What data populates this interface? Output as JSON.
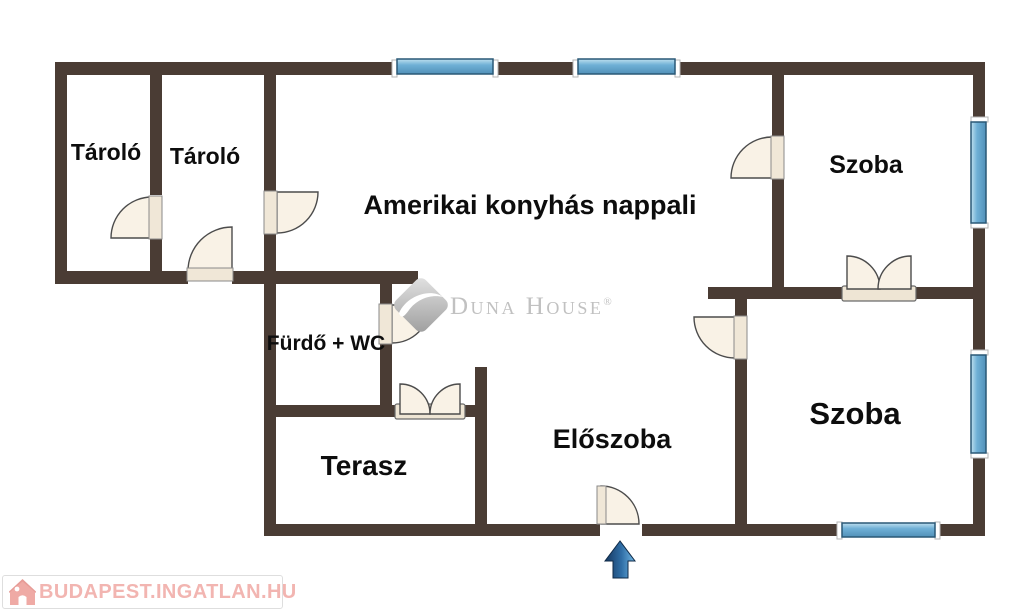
{
  "floorplan": {
    "type": "apartment-floor-plan",
    "rooms": [
      {
        "id": "tarolo-1",
        "label": "Tároló"
      },
      {
        "id": "tarolo-2",
        "label": "Tároló"
      },
      {
        "id": "nappali",
        "label": "Amerikai konyhás nappali"
      },
      {
        "id": "szoba-top",
        "label": "Szoba"
      },
      {
        "id": "furdo-wc",
        "label": "Fürdő + WC"
      },
      {
        "id": "terasz",
        "label": "Terasz"
      },
      {
        "id": "eloszoba",
        "label": "Előszoba"
      },
      {
        "id": "szoba-bottom",
        "label": "Szoba"
      }
    ],
    "watermark": {
      "brand": "Duna House",
      "registered": "®"
    },
    "footer_logo": {
      "text": "BUDAPEST.INGATLAN.HU"
    },
    "icons": [
      "dunahouse-diamond-icon",
      "house-icon",
      "entrance-arrow-icon"
    ],
    "colors": {
      "wall": "#4a3c34",
      "window_blue": "#6fb0d6",
      "window_border": "#2a5876",
      "door_fill": "#f9f2e6",
      "door_leaf": "#f0e7d7",
      "watermark_gray": "#c1c1c1",
      "logo_pink": "#f2b5b1",
      "arrow_blue_dark": "#16375f",
      "arrow_blue_light": "#71b6e4",
      "label_black": "#0d0d0d"
    }
  }
}
